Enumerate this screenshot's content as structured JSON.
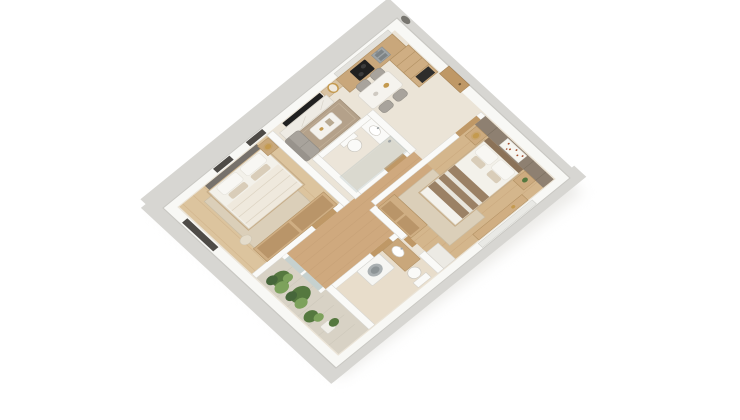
{
  "scene": {
    "description": "3D isometric cutaway render of a two-bedroom apartment floor plan on a white background",
    "view": "axonometric top-down, rotated 45 degrees",
    "background": "#ffffff"
  },
  "palette": {
    "wall_top": "#f8f8f5",
    "wall_side": "#d7d6d2",
    "outline": "#c9c8c3",
    "floor_cream": "#ebe4d7",
    "floor_wood": "#d4b68c",
    "floor_wood_dark": "#cfa97e",
    "floor_wood_light": "#dcc49e",
    "floor_tile": "#ece5d9",
    "floor_tile2": "#e8ddcb",
    "floor_balcony": "#d8d2c5",
    "accent_wall": "#8e8071",
    "artwork_white": "#f7f6f1",
    "artwork_red": "#a4502f",
    "counter_wood": "#c9a77b",
    "cabinet_wood": "#cfae83",
    "cabinet_dark": "#b99569",
    "upper_cabinet": "#e3e2dd",
    "tv_black": "#202020",
    "marble": "#eeebe4",
    "rug_living": "#b4a18a",
    "rug_beige": "#dbcfb9",
    "sofa_grey": "#a8a39c",
    "bed_white": "#f3f1ea",
    "blanket_brown": "#9b8165",
    "headboard_grey": "#76716b",
    "pillow_tan": "#d9cdb9",
    "gold": "#c49a4f",
    "plant_green": "#55783f",
    "plant_green_light": "#7da25c",
    "plant_green_dark": "#46663a",
    "fixture_white": "#fafaf8",
    "steel": "#9fa5a7",
    "glass": "#c6d1cf",
    "door_wood": "#bf9866",
    "window_dark": "#4e4b47"
  },
  "rooms": [
    {
      "id": "kitchen",
      "name": "Kitchen",
      "furniture": [
        "upper cabinets",
        "wood counter with sink",
        "black cooktop",
        "tall cabinet with oven"
      ]
    },
    {
      "id": "dining",
      "name": "Dining area",
      "furniture": [
        "white dining table",
        "four grey chairs",
        "console with round gold mirror"
      ]
    },
    {
      "id": "living",
      "name": "Living room",
      "furniture": [
        "wall TV",
        "marble media console",
        "taupe rug",
        "white coffee table",
        "grey sofa"
      ]
    },
    {
      "id": "master-bedroom",
      "name": "Master bedroom",
      "furniture": [
        "double bed with striped brown blanket",
        "brown accent wall with white artwork",
        "two nightstands",
        "gold table lamp",
        "beige rug",
        "side console",
        "low dresser"
      ]
    },
    {
      "id": "bedroom-2",
      "name": "Second bedroom",
      "furniture": [
        "double bed",
        "grey upholstered headboard",
        "nightstand with gold lamp",
        "wood wardrobe",
        "beige rug",
        "pouf"
      ]
    },
    {
      "id": "bathroom-1",
      "name": "Bathroom",
      "furniture": [
        "vanity with basin",
        "toilet",
        "glass shower"
      ]
    },
    {
      "id": "bathroom-2",
      "name": "Ensuite bathroom / laundry",
      "furniture": [
        "counter with basin",
        "washing machine",
        "toilet"
      ]
    },
    {
      "id": "hallway",
      "name": "Entry hall and corridor",
      "furniture": [
        "entrance door",
        "wood plank floor"
      ]
    },
    {
      "id": "balcony",
      "name": "Balcony",
      "furniture": [
        "potted plants",
        "glass sliding door"
      ]
    }
  ]
}
